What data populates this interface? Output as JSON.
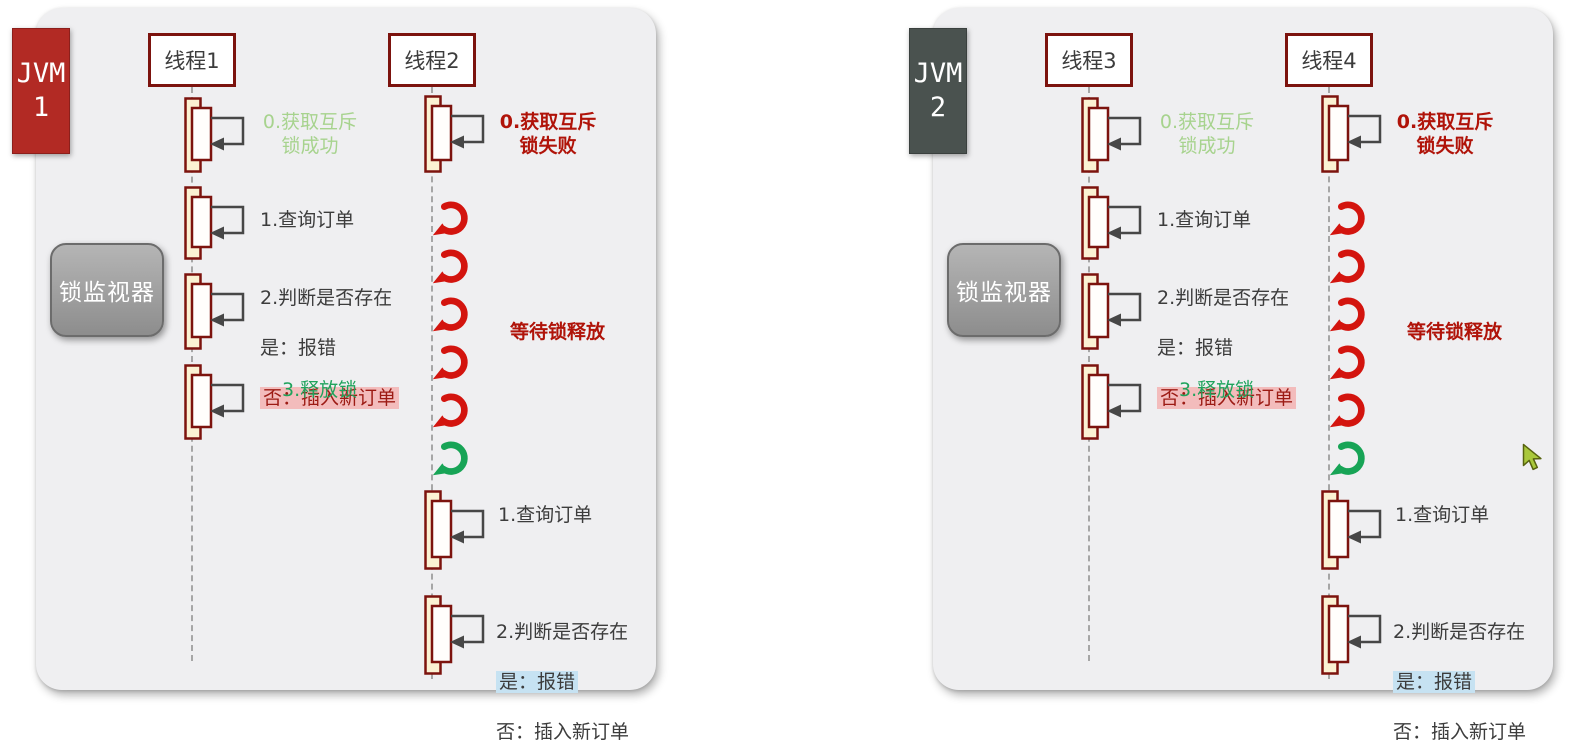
{
  "panels": [
    {
      "jvm_label": "JVM\n1",
      "monitor_label": "锁监视器",
      "threads": [
        {
          "name": "线程1",
          "steps": {
            "acquire": "0.获取互斥\n锁成功",
            "query": "1.查询订单",
            "judge": "2.判断是否存在",
            "judge_yes": "是：报错",
            "judge_no": "否：插入新订单",
            "release": "3.释放锁"
          }
        },
        {
          "name": "线程2",
          "steps": {
            "acquire": "0.获取互斥\n锁失败",
            "wait": "等待锁释放",
            "query": "1.查询订单",
            "judge": "2.判断是否存在",
            "judge_yes": "是：报错",
            "judge_no": "否：插入新订单"
          },
          "retry_arrows": [
            "red",
            "red",
            "red",
            "red",
            "red",
            "green"
          ]
        }
      ]
    },
    {
      "jvm_label": "JVM\n2",
      "monitor_label": "锁监视器",
      "threads": [
        {
          "name": "线程3",
          "steps": {
            "acquire": "0.获取互斥\n锁成功",
            "query": "1.查询订单",
            "judge": "2.判断是否存在",
            "judge_yes": "是：报错",
            "judge_no": "否：插入新订单",
            "release": "3.释放锁"
          }
        },
        {
          "name": "线程4",
          "steps": {
            "acquire": "0.获取互斥\n锁失败",
            "wait": "等待锁释放",
            "query": "1.查询订单",
            "judge": "2.判断是否存在",
            "judge_yes": "是：报错",
            "judge_no": "否：插入新订单"
          },
          "retry_arrows": [
            "red",
            "red",
            "red",
            "red",
            "red",
            "green"
          ]
        }
      ]
    }
  ],
  "colors": {
    "panel_bg": "#efeff1",
    "maroon_border": "#7c130e",
    "jvm1_red": "#b22a24",
    "jvm2_slate": "#4a524f",
    "monitor_gray": "#9e9e9e",
    "activation_cream": "#fbf2d3",
    "activation_white": "#fffefc",
    "self_arrow_gray": "#474747",
    "light_green_text": "#a7d38e",
    "green_text": "#1fa35c",
    "dark_red_text": "#b01309",
    "pink_highlight": "#f3bcbc",
    "blue_highlight": "#c6e2f2",
    "retry_red": "#d3140e",
    "retry_green": "#17a456",
    "cursor_green": "#a9c83b"
  }
}
